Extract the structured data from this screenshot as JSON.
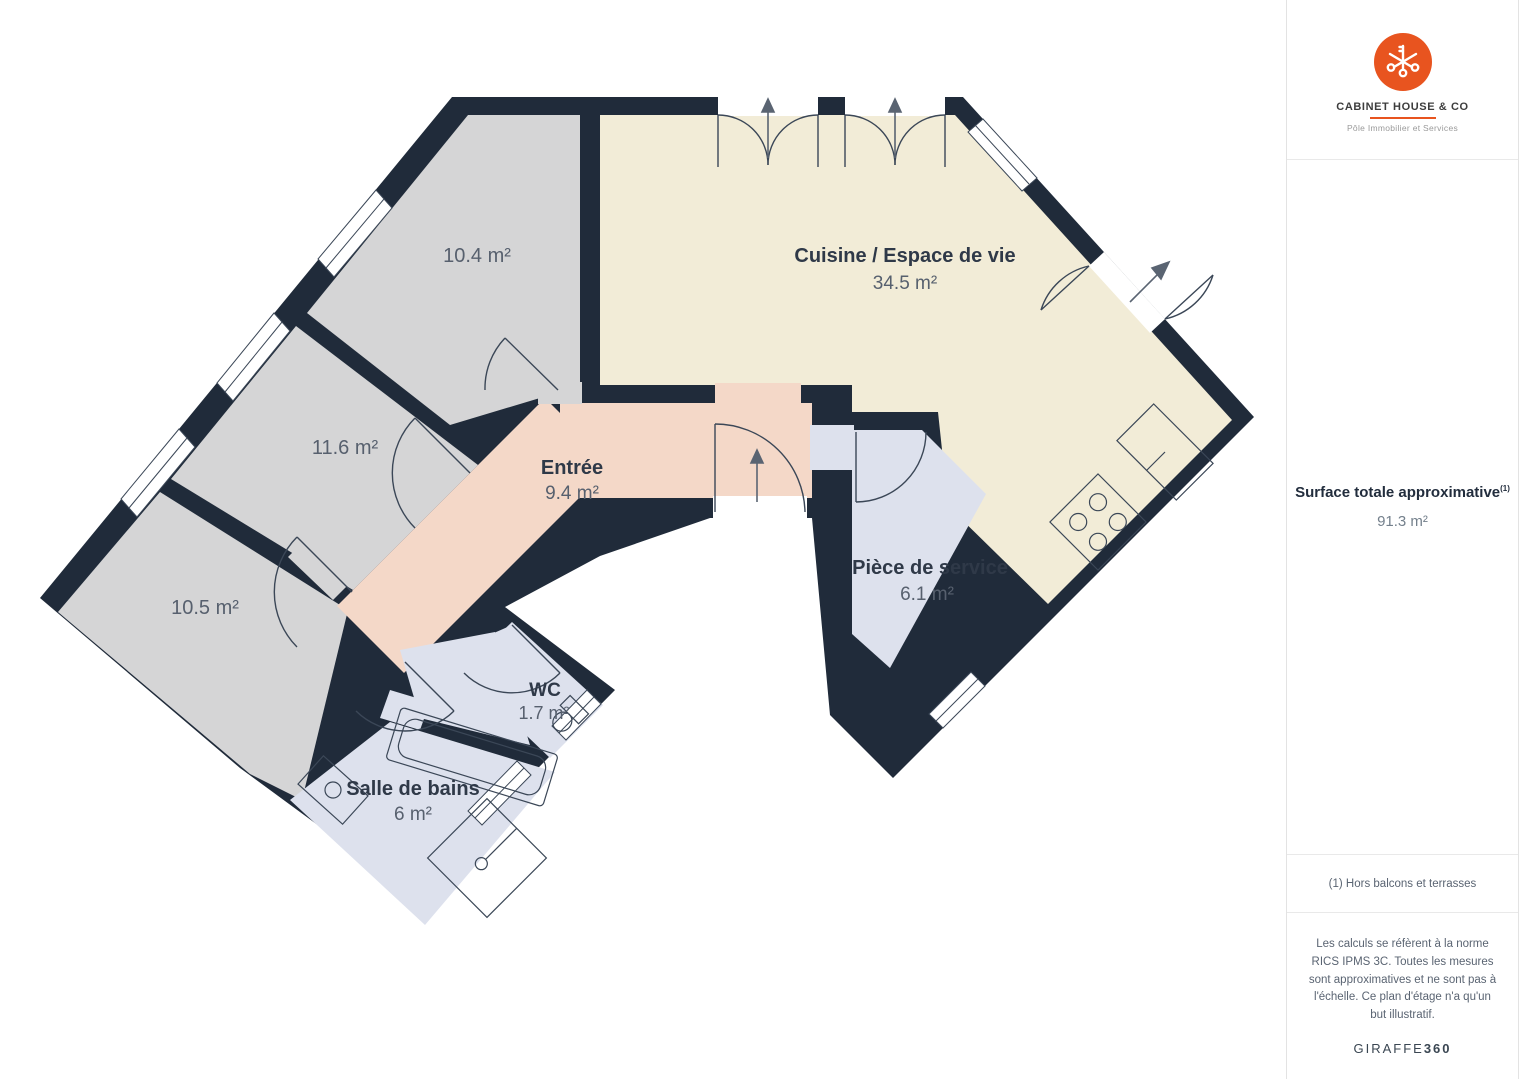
{
  "plan": {
    "rooms": [
      {
        "name": "",
        "area": "10.4 m²"
      },
      {
        "name": "Cuisine / Espace de vie",
        "area": "34.5 m²"
      },
      {
        "name": "",
        "area": "11.6 m²"
      },
      {
        "name": "Entrée",
        "area": "9.4 m²"
      },
      {
        "name": "",
        "area": "10.5 m²"
      },
      {
        "name": "Pièce de service",
        "area": "6.1 m²"
      },
      {
        "name": "WC",
        "area": "1.7 m²"
      },
      {
        "name": "Salle de bains",
        "area": "6 m²"
      }
    ],
    "colors": {
      "walls": "#202b3a",
      "room_gray": "#d5d5d6",
      "room_cream": "#f2ecd7",
      "room_salmon": "#f4d8c8",
      "room_periwinkle": "#dde1ed"
    }
  },
  "sidebar": {
    "brand": {
      "name": "CABINET HOUSE & CO",
      "tagline": "Pôle Immobilier et Services",
      "accent_color": "#e8541f"
    },
    "surface": {
      "label": "Surface totale approximative",
      "superscript": "(1)",
      "value": "91.3 m²"
    },
    "footnote": "(1) Hors balcons et terrasses",
    "disclaimer": "Les calculs se réfèrent à la norme RICS IPMS 3C. Toutes les mesures sont approximatives et ne sont pas à l'échelle. Ce plan d'étage n'a qu'un but illustratif.",
    "watermark": {
      "brand": "GIRAFFE",
      "suffix": "360"
    }
  }
}
